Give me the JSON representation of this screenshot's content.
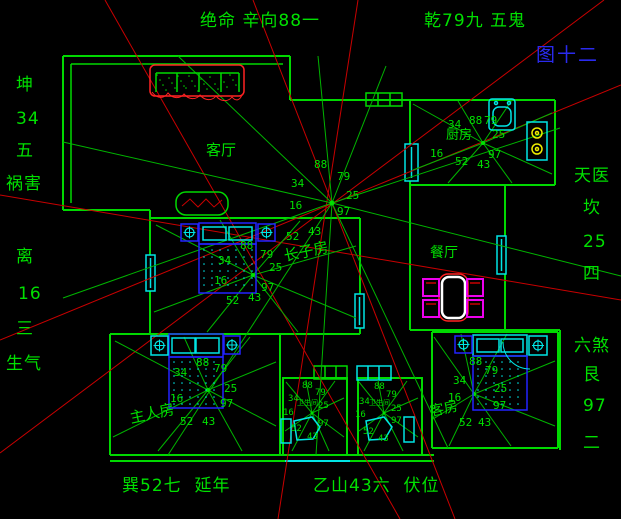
{
  "figure": {
    "top_center": "绝命 辛向88一",
    "top_right": "乾79九 五鬼",
    "figure_no": "图十二",
    "bottom_left": "巽52七  延年",
    "bottom_right": "乙山43六  伏位"
  },
  "left_column": {
    "trigram_top": "坤",
    "number_top": "34",
    "rank_top": "五",
    "star_top": "祸害",
    "trigram_bottom": "离",
    "number_bottom": "16",
    "rank_bottom": "三",
    "star_bottom": "生气"
  },
  "right_column": {
    "star_top": "天医",
    "trigram_top": "坎",
    "number_top": "25",
    "rank_top": "四",
    "star_bottom": "六煞",
    "trigram_bottom": "艮",
    "number_bottom": "97",
    "rank_bottom": "二"
  },
  "room_labels": {
    "living": "客厅",
    "kitchen": "厨房",
    "dining": "餐厅",
    "eldest_son": "长子房",
    "master": "主人房",
    "guest": "客房",
    "bathroom": "卫生间"
  },
  "star_numbers": {
    "s88": "88",
    "s79": "79",
    "s34": "34",
    "s25": "25",
    "s16": "16",
    "s97": "97",
    "s43": "43",
    "s52": "52"
  },
  "colors": {
    "wall_green": "#00d900",
    "text_green": "#00e000",
    "line_red": "#c80000",
    "furniture_red": "#ff2222",
    "cyan": "#00e5e5",
    "blue": "#2222ff",
    "magenta": "#ee00ee",
    "yellow": "#eded00",
    "figure_blue": "#2a2aee",
    "white": "#ffffff"
  }
}
